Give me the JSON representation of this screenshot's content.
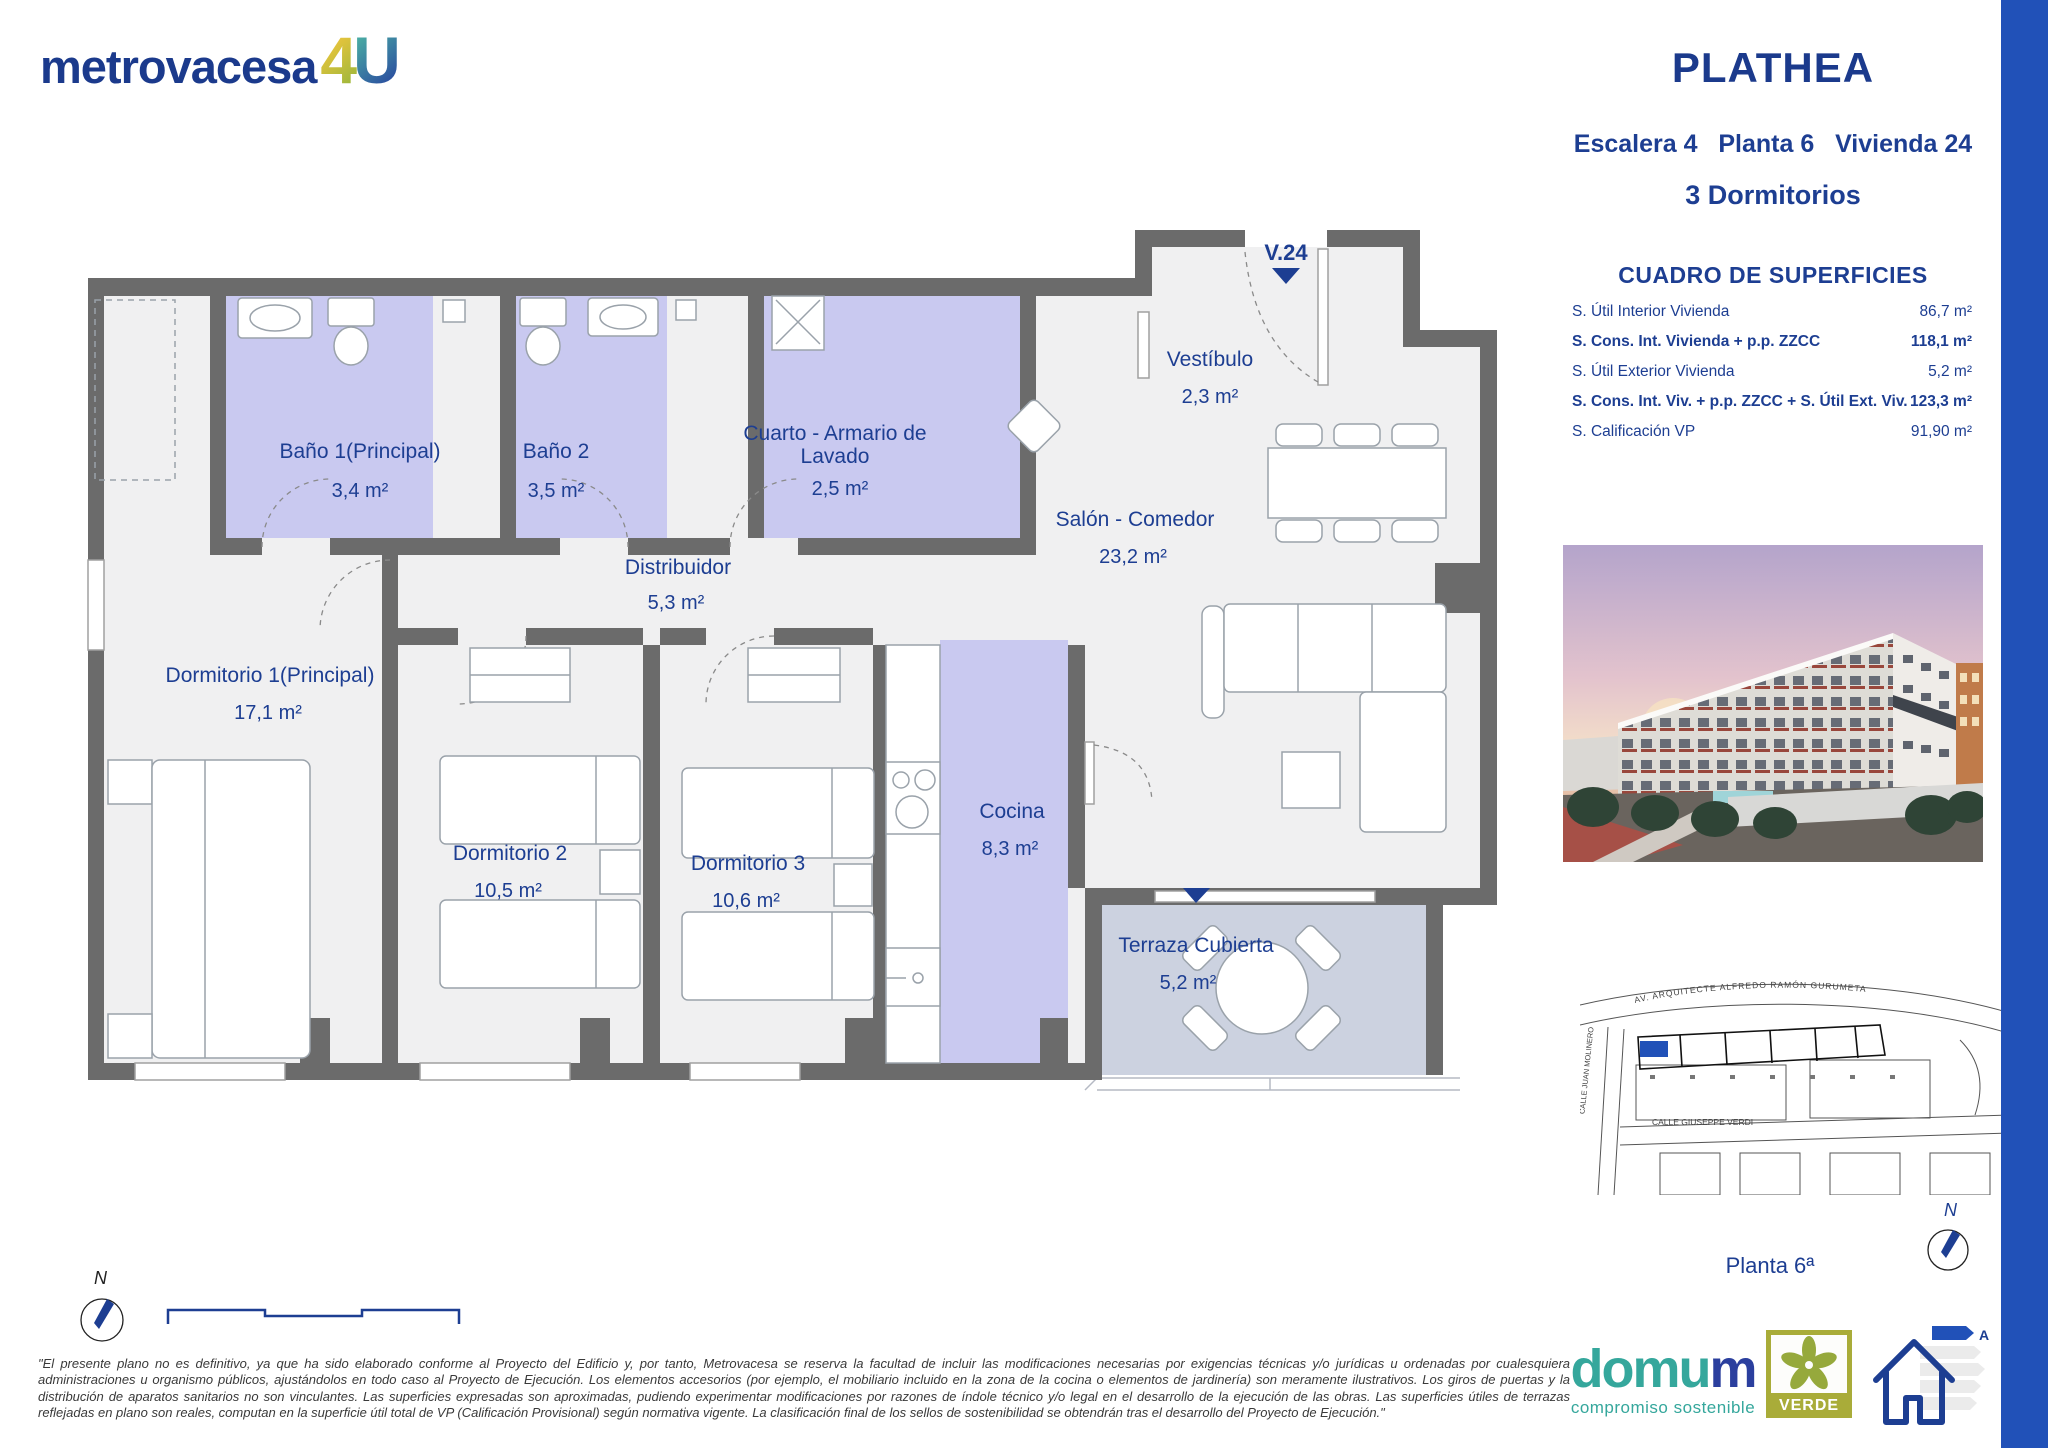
{
  "header": {
    "logo_word": "metrovacesa",
    "logo_4": "4",
    "logo_u": "U",
    "project": "PLATHEA",
    "unit_line": "Escalera 4   Planta 6   Vivienda 24",
    "bedrooms": "3 Dormitorios"
  },
  "surfaces": {
    "title": "CUADRO DE SUPERFICIES",
    "rows": [
      {
        "label": "S. Útil Interior Vivienda",
        "value": "86,7 m²"
      },
      {
        "label": "S. Cons. Int. Vivienda + p.p. ZZCC",
        "value": "118,1 m²"
      },
      {
        "label": "S. Útil Exterior Vivienda",
        "value": "5,2 m²"
      },
      {
        "label": "S. Cons. Int. Viv. + p.p. ZZCC + S. Útil Ext. Viv.",
        "value": "123,3 m²"
      },
      {
        "label": "S. Calificación VP",
        "value": "91,90 m²"
      }
    ]
  },
  "floorplan": {
    "door_label": "V.24",
    "rooms": [
      {
        "name": "Baño 1(Principal)",
        "area": "3,4 m²"
      },
      {
        "name": "Baño 2",
        "area": "3,5 m²"
      },
      {
        "name": "Cuarto - Armario de Lavado",
        "area": "2,5 m²"
      },
      {
        "name": "Vestíbulo",
        "area": "2,3 m²"
      },
      {
        "name": "Distribuidor",
        "area": "5,3 m²"
      },
      {
        "name": "Salón - Comedor",
        "area": "23,2 m²"
      },
      {
        "name": "Dormitorio 1(Principal)",
        "area": "17,1 m²"
      },
      {
        "name": "Dormitorio 2",
        "area": "10,5 m²"
      },
      {
        "name": "Dormitorio 3",
        "area": "10,6 m²"
      },
      {
        "name": "Cocina",
        "area": "8,3 m²"
      },
      {
        "name": "Terraza Cubierta",
        "area": "5,2 m²"
      }
    ],
    "colors": {
      "wall": "#6b6b6b",
      "wet_room_fill": "#c9c9f0",
      "terrace_fill": "#ccd2e0",
      "floor_fill": "#f0f0f1",
      "label": "#1d3e92"
    }
  },
  "siteplan": {
    "street_avenue": "AV. ARQUITECTE ALFREDO RAMÓN GURUMETA",
    "street_left": "CALLE JUAN MOLINERO",
    "street_bottom": "CALLE GIUSEPPE VERDI",
    "floor_label": "Planta 6ª",
    "north_label": "N",
    "highlight_color": "#2151b8"
  },
  "compass": {
    "north_label": "N"
  },
  "footer": {
    "legal": "\"El presente plano no es definitivo, ya que ha sido elaborado conforme al Proyecto del Edificio y, por tanto, Metrovacesa se reserva la facultad de incluir las modificaciones necesarias por exigencias técnicas y/o jurídicas u ordenadas por cualesquiera administraciones u organismo públicos, ajustándolos en todo caso al Proyecto de Ejecución. Los elementos accesorios (por ejemplo, el mobiliario incluido en la zona de la cocina o elementos de jardinería) son meramente ilustrativos. Los giros de puertas y la distribución de aparatos sanitarios no son vinculantes. Las superficies expresadas son aproximadas, pudiendo experimentar modificaciones por razones de índole técnico y/o legal en el desarrollo de la ejecución de las obras. Las superficies útiles de terrazas reflejadas en plano son reales, computan en la superficie útil total de VP (Calificación Provisional) según normativa vigente. La clasificación final de los sellos de sostenibilidad se obtendrán tras el desarrollo del Proyecto de Ejecución.\"",
    "domum_word_a": "domu",
    "domum_word_b": "m",
    "domum_tagline": "compromiso sostenible",
    "verde_label": "VERDE",
    "energy_label": "A"
  }
}
